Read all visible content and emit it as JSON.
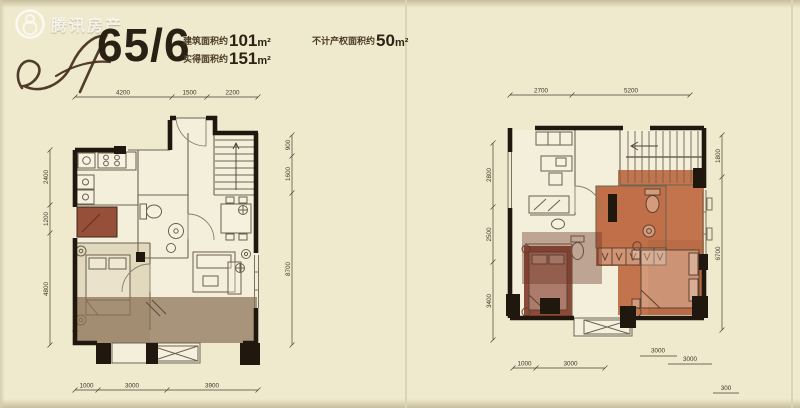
{
  "watermark": {
    "brand": "腾讯房产"
  },
  "header": {
    "unit_number": "65/6",
    "areas": [
      {
        "label": "建筑面积约",
        "value": "101",
        "unit": "m²"
      },
      {
        "label": "实得面积约",
        "value": "151",
        "unit": "m²"
      },
      {
        "label": "不计产权面积约",
        "value": "50",
        "unit": "m²"
      }
    ]
  },
  "plan_left": {
    "dims_top": [
      "4200",
      "1500",
      "2200"
    ],
    "dims_left": [
      "2400",
      "1200",
      "4800"
    ],
    "dims_right": [
      "900",
      "1600",
      "8700"
    ],
    "dims_bottom": [
      "1000",
      "3000",
      "3900"
    ]
  },
  "plan_right": {
    "dims_top": [
      "2700",
      "5200"
    ],
    "dims_left": [
      "2800",
      "2500",
      "3400"
    ],
    "dims_right": [
      "1800",
      "6700"
    ],
    "dims_bottom": [
      "1000",
      "3000"
    ],
    "dims_bottom_offset": [
      "3000",
      "3000",
      "300"
    ]
  },
  "colors": {
    "background": "#efe9cd",
    "wall": "#20180f",
    "small_room_red": "#96503a",
    "suite_orange": "#c3744c",
    "bedroom_dark_red": "#8d4a38",
    "overlay_brown": "#8a7054",
    "dim_text": "#3e362a"
  }
}
